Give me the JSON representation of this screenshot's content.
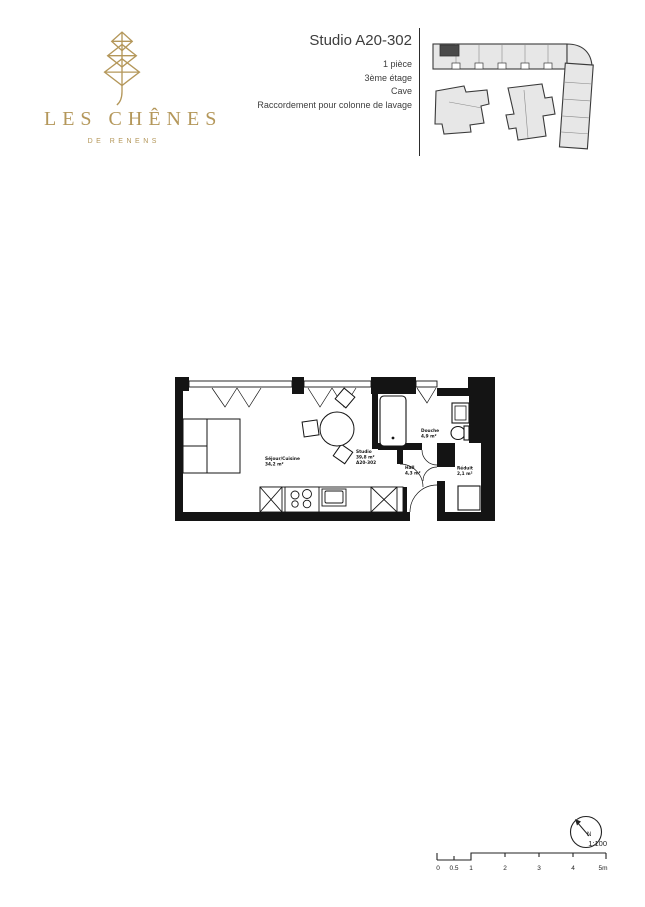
{
  "header": {
    "logo": {
      "title": "LES CHÊNES",
      "subtitle": "DE RENENS"
    },
    "unit": {
      "title": "Studio A20-302",
      "details": [
        "1 pièce",
        "3ème étage",
        "Cave",
        "Raccordement pour colonne de lavage"
      ]
    }
  },
  "floor_plan": {
    "rooms": {
      "sejour": {
        "name": "Séjour/Cuisine",
        "area": "34,2 m²"
      },
      "studio": {
        "name": "Studio",
        "area": "39,8 m²",
        "code": "A20-302"
      },
      "douche": {
        "name": "Douche",
        "area": "4,9 m²"
      },
      "hall": {
        "name": "Hall",
        "area": "4,3 m²"
      },
      "reduit": {
        "name": "Réduit",
        "area": "2,1 m²"
      }
    }
  },
  "footer": {
    "north_label": "N",
    "scale": {
      "ratio": "1:100",
      "ticks": [
        "0",
        "0.5",
        "1",
        "2",
        "3",
        "4",
        "5m"
      ]
    }
  },
  "colors": {
    "brand_gold": "#b4975a",
    "plan_ink": "#141414",
    "text_gray": "#3d3d3d",
    "siteplan_fill": "#e7e7e7",
    "siteplan_highlight": "#4a4a4a"
  }
}
